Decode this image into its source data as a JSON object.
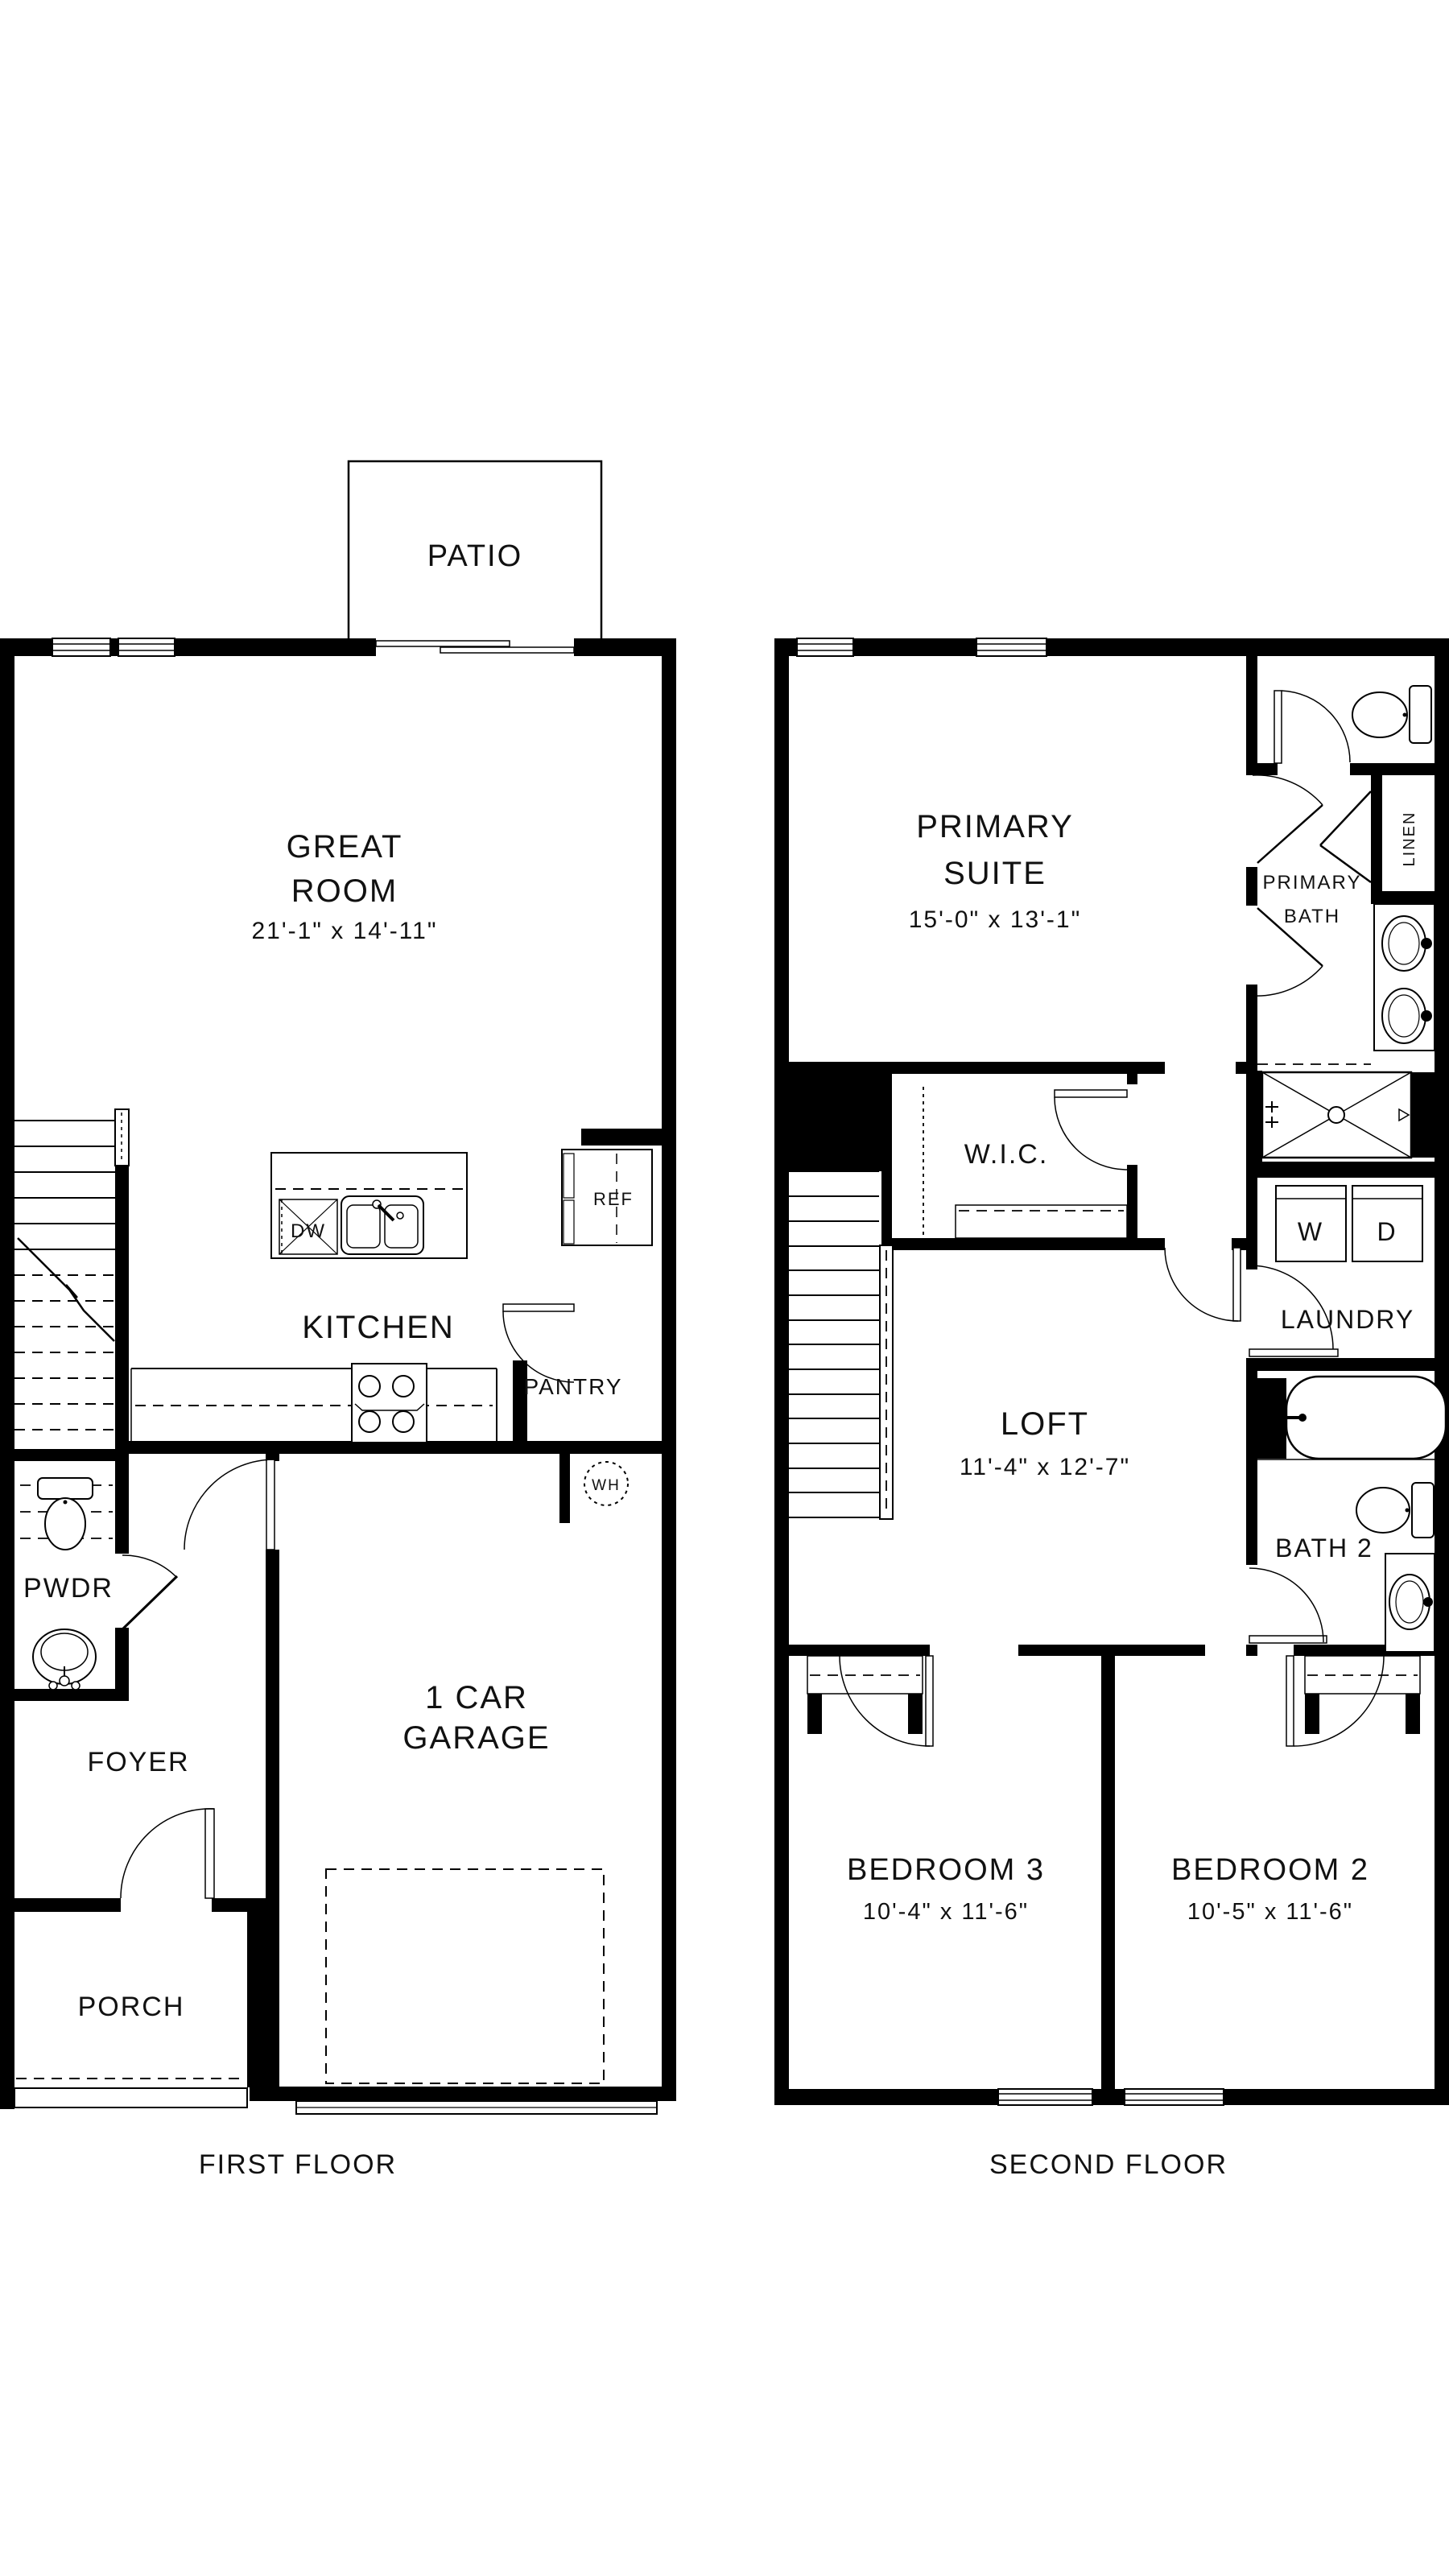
{
  "floor1": {
    "label": "FIRST FLOOR",
    "patio": "PATIO",
    "great_room_line1": "GREAT",
    "great_room_line2": "ROOM",
    "great_room_dims": "21'-1\" x 14'-11\"",
    "kitchen": "KITCHEN",
    "pantry": "PANTRY",
    "ref": "REF",
    "dw": "DW",
    "wh": "WH",
    "pwdr": "PWDR",
    "foyer": "FOYER",
    "porch": "PORCH",
    "garage_line1": "1 CAR",
    "garage_line2": "GARAGE"
  },
  "floor2": {
    "label": "SECOND FLOOR",
    "primary_suite_line1": "PRIMARY",
    "primary_suite_line2": "SUITE",
    "primary_suite_dims": "15'-0\" x 13'-1\"",
    "primary_bath_line1": "PRIMARY",
    "primary_bath_line2": "BATH",
    "linen": "LINEN",
    "wic": "W.I.C.",
    "laundry": "LAUNDRY",
    "washer": "W",
    "dryer": "D",
    "loft": "LOFT",
    "loft_dims": "11'-4\" x 12'-7\"",
    "bath2": "BATH 2",
    "bedroom3": "BEDROOM 3",
    "bedroom3_dims": "10'-4\" x 11'-6\"",
    "bedroom2": "BEDROOM 2",
    "bedroom2_dims": "10'-5\" x 11'-6\""
  },
  "colors": {
    "line": "#000000",
    "background": "#ffffff"
  }
}
